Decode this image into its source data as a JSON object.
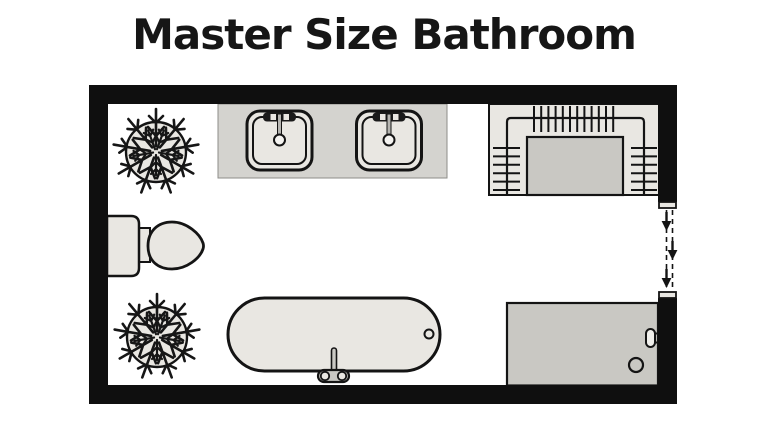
{
  "title": "Master Size Bathroom",
  "colors": {
    "background": "#ffffff",
    "wall": "#0f0f0f",
    "fixture_light": "#e9e7e2",
    "fixture_mid": "#d4d3cf",
    "fixture_dark": "#c9c8c3",
    "outline": "#141414"
  },
  "floor_plan": {
    "kind": "bathroom-top-view",
    "fixtures": [
      {
        "name": "plant-top-left-icon",
        "label": "potted plant"
      },
      {
        "name": "vanity-counter",
        "label": "double sink vanity"
      },
      {
        "name": "sink-left-icon",
        "label": "sink"
      },
      {
        "name": "sink-right-icon",
        "label": "sink"
      },
      {
        "name": "closet-racks",
        "label": "closet with hanging racks and island"
      },
      {
        "name": "toilet-icon",
        "label": "toilet"
      },
      {
        "name": "plant-bottom-left-icon",
        "label": "potted plant"
      },
      {
        "name": "bathtub-icon",
        "label": "bathtub with faucet and drain"
      },
      {
        "name": "shower-icon",
        "label": "walk-in shower with drain and handle"
      },
      {
        "name": "door-opening",
        "label": "door opening with three entry arrows",
        "arrow_count": 3
      }
    ]
  }
}
